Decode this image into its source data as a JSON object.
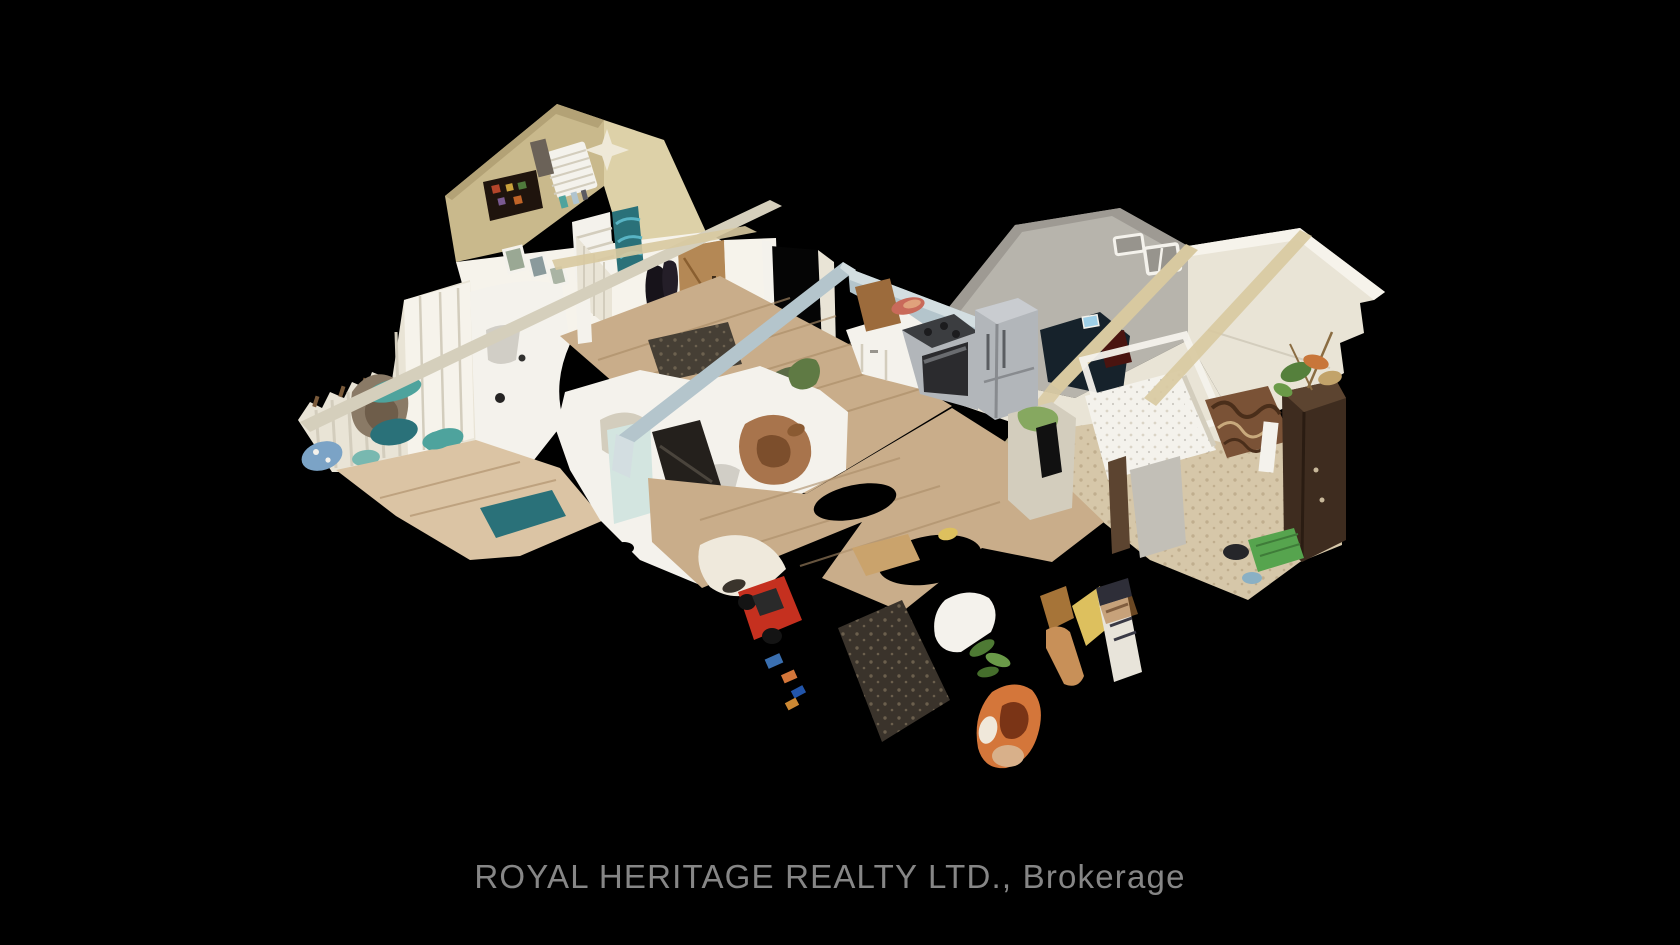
{
  "scene": {
    "type": "3d-dollhouse-virtual-tour",
    "caption": "ROYAL HERITAGE REALTY LTD., Brokerage",
    "description": "Matterport-style 3D dollhouse cutaway of a one-storey home interior floating on a black background. Top: tan bedroom with white window blinds, dark collage poster and ceiling fan. Left: white-panelled room with ragged curtains, teal bedding and plush brown mass. Centre: wood-floor entry hall with oak door, black open doorway and dark doormat; white sectional sofa fragments with a brown dog and TV panel; kitchen with white cabinets, gas stove, stainless refrigerator and cutting board under light-blue cut wall tops. Right: large cream family room with two small windows, dark sofa nook with glowing laptop; bedroom with white canopy bed, ornate scroll bench, beige shag rug, dark wardrobe topped with dried flowers, hanging towel and green toy bin. Bottom: torn scan edge with wood-floor shreds, black holes, red toy car, dark mat, green leaves, orange fabric, yellow fragments and a small white sign."
  },
  "palette": {
    "bg": "#000000",
    "caption": "#868686",
    "tan-wall": "#c9b98c",
    "tan-wall-dark": "#b3a276",
    "tan-wall-light": "#ddd1a8",
    "cream": "#e9e4d6",
    "cream-bright": "#f6f3eb",
    "cream-shadow": "#d3cdbd",
    "gray-wall": "#c2bfb7",
    "gray-wall-dark": "#97948d",
    "blue-cut": "#b4c5cc",
    "blue-cut-light": "#d3dee1",
    "khaki": "#d8c9a0",
    "wood": "#c9ad8a",
    "wood-dark": "#ab8d68",
    "wood-light": "#dbc4a4",
    "carpet": "#d6c7a9",
    "carpet-dark": "#b4a080",
    "doormat": "#463f35",
    "steel": "#b2b6ba",
    "steel-dark": "#888b8f",
    "oven": "#2b2b2e",
    "wardrobe": "#3e2c1f",
    "wardrobe-light": "#5c4430",
    "teal": "#4ea39d",
    "teal-dark": "#2a7179",
    "blue-fabric": "#7ba3c6",
    "red": "#c5301f",
    "orange": "#d4763a",
    "yellow": "#ddc05e",
    "green": "#55803c",
    "navy": "#16222b",
    "wood-brown": "#9c6b3c",
    "white": "#f4f2ec",
    "poster": "#1f140d",
    "mint": "#d3e5e0"
  }
}
